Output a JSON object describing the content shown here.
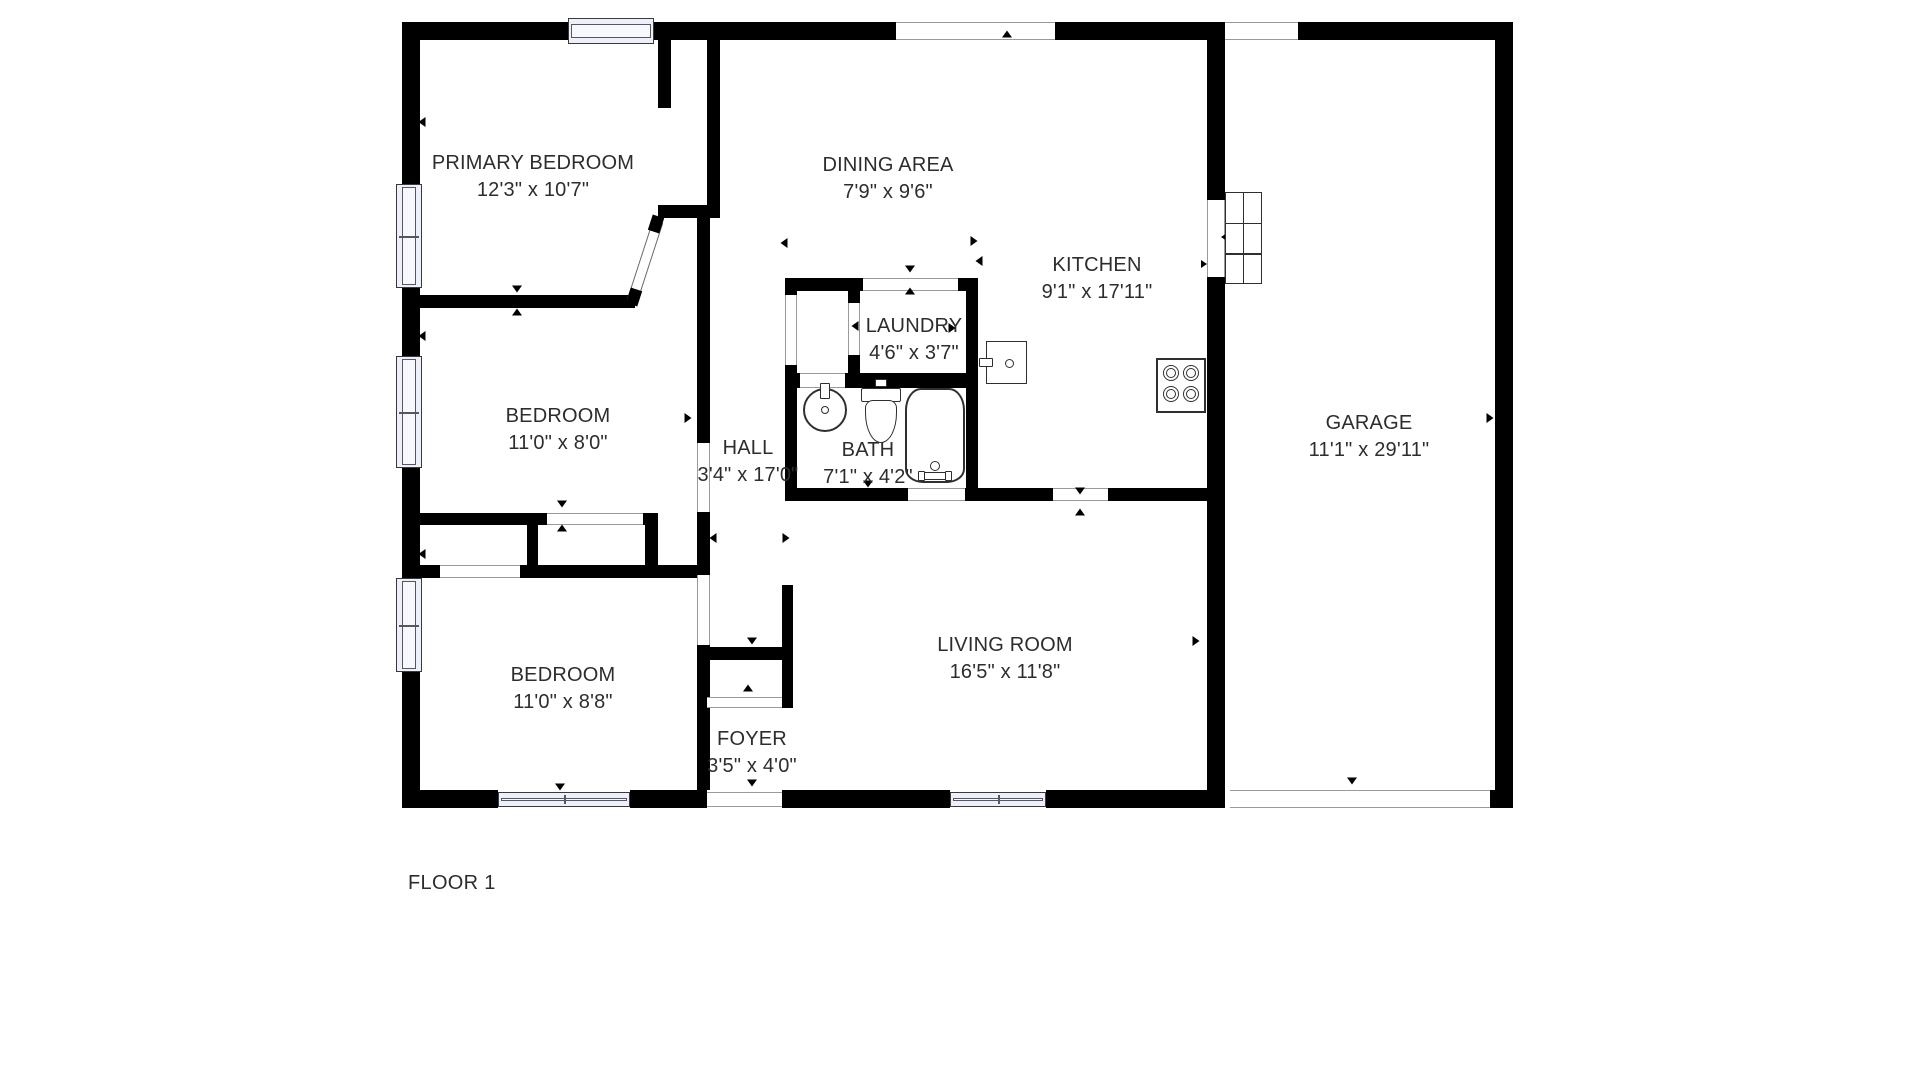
{
  "floor_label": "FLOOR 1",
  "canvas": {
    "w": 1920,
    "h": 1080
  },
  "colors": {
    "wall": "#000000",
    "text": "#2d2d2d",
    "window_fill": "#eef0f9",
    "fixture_outline": "#2f2f2f"
  },
  "rooms": [
    {
      "id": "primary-bedroom",
      "name": "PRIMARY BEDROOM",
      "dims": "12'3\" x 10'7\"",
      "cx": 533,
      "cy": 150
    },
    {
      "id": "dining-area",
      "name": "DINING AREA",
      "dims": "7'9\" x 9'6\"",
      "cx": 888,
      "cy": 152
    },
    {
      "id": "kitchen",
      "name": "KITCHEN",
      "dims": "9'1\" x 17'11\"",
      "cx": 1097,
      "cy": 252
    },
    {
      "id": "laundry",
      "name": "LAUNDRY",
      "dims": "4'6\" x 3'7\"",
      "cx": 914,
      "cy": 313
    },
    {
      "id": "bedroom-middle",
      "name": "BEDROOM",
      "dims": "11'0\" x 8'0\"",
      "cx": 558,
      "cy": 403
    },
    {
      "id": "hall",
      "name": "HALL",
      "dims": "3'4\" x 17'0\"",
      "cx": 748,
      "cy": 435
    },
    {
      "id": "bath",
      "name": "BATH",
      "dims": "7'1\" x 4'2\"",
      "cx": 868,
      "cy": 437
    },
    {
      "id": "bedroom-lower",
      "name": "BEDROOM",
      "dims": "11'0\" x 8'8\"",
      "cx": 563,
      "cy": 662
    },
    {
      "id": "living-room",
      "name": "LIVING ROOM",
      "dims": "16'5\" x 11'8\"",
      "cx": 1005,
      "cy": 632
    },
    {
      "id": "foyer",
      "name": "FOYER",
      "dims": "3'5\" x 4'0\"",
      "cx": 752,
      "cy": 726
    },
    {
      "id": "garage",
      "name": "GARAGE",
      "dims": "11'1\" x 29'11\"",
      "cx": 1369,
      "cy": 410
    }
  ],
  "walls": [
    [
      402,
      22,
      18,
      786
    ],
    [
      402,
      22,
      166,
      18
    ],
    [
      654,
      22,
      242,
      18
    ],
    [
      1055,
      22,
      170,
      18
    ],
    [
      1298,
      22,
      215,
      18
    ],
    [
      1495,
      22,
      18,
      786
    ],
    [
      402,
      790,
      96,
      18
    ],
    [
      630,
      790,
      77,
      18
    ],
    [
      782,
      790,
      168,
      18
    ],
    [
      1046,
      790,
      179,
      18
    ],
    [
      1490,
      790,
      23,
      18
    ],
    [
      1207,
      22,
      18,
      178
    ],
    [
      1207,
      277,
      18,
      531
    ],
    [
      402,
      295,
      233,
      13
    ],
    [
      658,
      40,
      13,
      68
    ],
    [
      707,
      22,
      13,
      196
    ],
    [
      658,
      205,
      62,
      13
    ],
    [
      697,
      218,
      13,
      225
    ],
    [
      697,
      512,
      13,
      63
    ],
    [
      697,
      645,
      13,
      145
    ],
    [
      402,
      513,
      256,
      12
    ],
    [
      527,
      513,
      11,
      65
    ],
    [
      645,
      513,
      13,
      65
    ],
    [
      402,
      565,
      305,
      13
    ],
    [
      697,
      647,
      96,
      13
    ],
    [
      782,
      585,
      11,
      123
    ],
    [
      785,
      278,
      193,
      13
    ],
    [
      785,
      278,
      12,
      17
    ],
    [
      785,
      365,
      12,
      135
    ],
    [
      848,
      278,
      12,
      25
    ],
    [
      848,
      355,
      12,
      33
    ],
    [
      966,
      278,
      12,
      222
    ],
    [
      785,
      373,
      15,
      15
    ],
    [
      845,
      373,
      121,
      15
    ],
    [
      785,
      488,
      123,
      13
    ],
    [
      965,
      488,
      13,
      13
    ],
    [
      978,
      488,
      75,
      13
    ],
    [
      1108,
      488,
      117,
      13
    ]
  ],
  "windows": [
    [
      568,
      18,
      86,
      26
    ],
    [
      396,
      184,
      26,
      104
    ],
    [
      396,
      356,
      26,
      112
    ],
    [
      396,
      578,
      26,
      94
    ],
    [
      498,
      792,
      132,
      15
    ],
    [
      950,
      792,
      96,
      15
    ]
  ],
  "openings": [
    [
      896,
      22,
      159,
      18
    ],
    [
      1225,
      22,
      73,
      18
    ],
    [
      1230,
      790,
      260,
      18
    ],
    [
      707,
      792,
      75,
      15
    ],
    [
      1207,
      200,
      18,
      77
    ],
    [
      863,
      278,
      95,
      13
    ],
    [
      547,
      513,
      96,
      12
    ],
    [
      440,
      565,
      80,
      13
    ],
    [
      707,
      697,
      75,
      11
    ],
    [
      785,
      295,
      12,
      70
    ],
    [
      848,
      303,
      12,
      52
    ],
    [
      800,
      373,
      45,
      15
    ],
    [
      908,
      488,
      57,
      13
    ],
    [
      1053,
      488,
      55,
      13
    ],
    [
      697,
      443,
      13,
      69
    ],
    [
      697,
      575,
      13,
      70
    ]
  ],
  "markers": [
    [
      515,
      33,
      "up",
      7
    ],
    [
      422,
      122,
      "left",
      7
    ],
    [
      678,
      214,
      "down",
      7
    ],
    [
      517,
      289,
      "down",
      7
    ],
    [
      517,
      312,
      "up",
      7
    ],
    [
      784,
      243,
      "left",
      7
    ],
    [
      974,
      241,
      "right",
      7
    ],
    [
      979,
      261,
      "left",
      7
    ],
    [
      1007,
      34,
      "up",
      7
    ],
    [
      1352,
      29,
      "down",
      7
    ],
    [
      910,
      269,
      "down",
      7
    ],
    [
      910,
      291,
      "up",
      7
    ],
    [
      855,
      326,
      "left",
      7
    ],
    [
      952,
      328,
      "right",
      7
    ],
    [
      422,
      336,
      "left",
      7
    ],
    [
      688,
      418,
      "right",
      7
    ],
    [
      868,
      484,
      "down",
      7
    ],
    [
      562,
      504,
      "down",
      7
    ],
    [
      562,
      528,
      "up",
      7
    ],
    [
      422,
      554,
      "left",
      7
    ],
    [
      713,
      538,
      "left",
      7
    ],
    [
      786,
      538,
      "right",
      7
    ],
    [
      752,
      641,
      "down",
      7
    ],
    [
      748,
      688,
      "up",
      7
    ],
    [
      560,
      787,
      "down",
      7
    ],
    [
      752,
      783,
      "down",
      7
    ],
    [
      1080,
      491,
      "down",
      7
    ],
    [
      1080,
      512,
      "up",
      7
    ],
    [
      1196,
      641,
      "right",
      7
    ],
    [
      1490,
      418,
      "right",
      7
    ],
    [
      1352,
      781,
      "down",
      7
    ],
    [
      1227,
      237,
      "left",
      12
    ],
    [
      1204,
      264,
      "right",
      6
    ]
  ],
  "door": {
    "cx": 645,
    "cy": 261,
    "len": 84,
    "thick": 11,
    "angle": 108
  },
  "door_stubs": [
    [
      656,
      224
    ],
    [
      634,
      297
    ]
  ],
  "fixtures": [
    {
      "type": "sink",
      "x": 803,
      "y": 388,
      "w": 44,
      "h": 44
    },
    {
      "type": "toilet",
      "x": 861,
      "y": 379,
      "w": 40,
      "h": 64
    },
    {
      "type": "bathtub",
      "x": 905,
      "y": 388,
      "w": 60,
      "h": 95
    },
    {
      "type": "stove",
      "x": 1156,
      "y": 358,
      "w": 50,
      "h": 55
    },
    {
      "type": "washer",
      "x": 986,
      "y": 341,
      "w": 41,
      "h": 43
    },
    {
      "type": "garage-steps",
      "x": 1225,
      "y": 192,
      "w": 37,
      "h": 92
    }
  ]
}
